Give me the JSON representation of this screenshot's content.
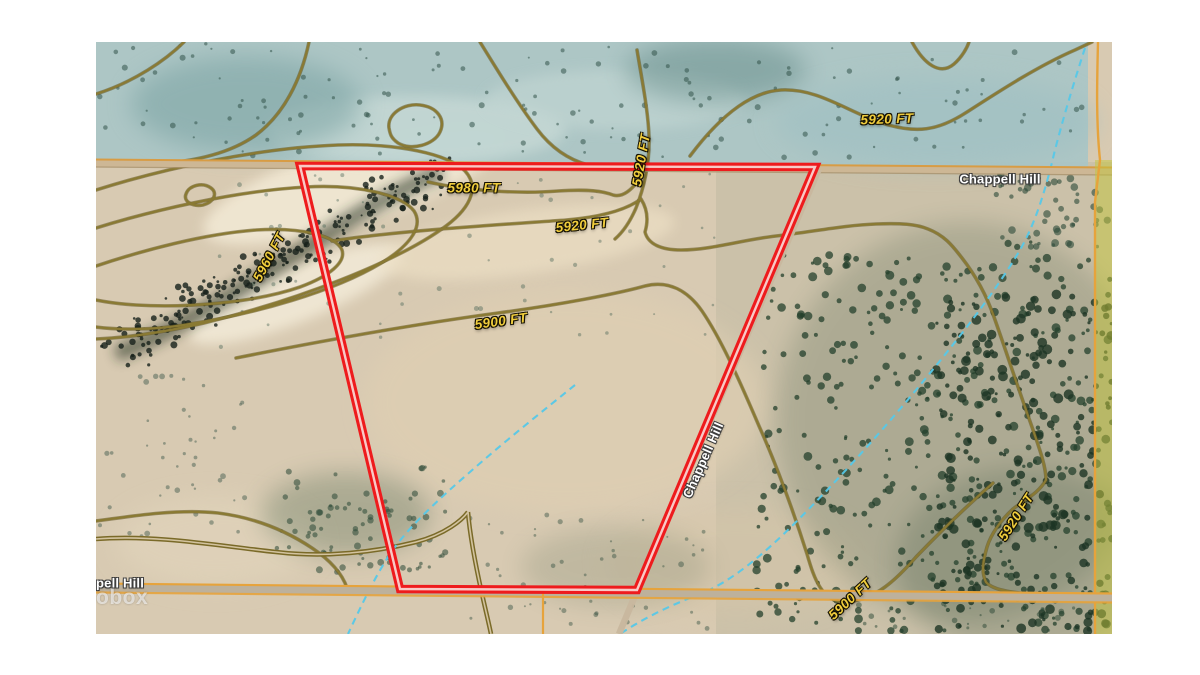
{
  "map": {
    "description_hint": "satellite topographic map with parcel boundary overlay",
    "contour_labels": {
      "ne_5920": "5920 FT",
      "nw_5980": "5980 FT",
      "mid_5920": "5920 FT",
      "mid_5900": "5900 FT",
      "west_5960": "5960 FT",
      "top_5920": "5920 FT",
      "east_5920": "5920 FT",
      "south_5900": "5900 FT"
    },
    "road_labels": {
      "top": "Chappell Hill",
      "diagonal": "Chappell Hill",
      "bottom_clipped": "pell Hill"
    },
    "watermark": "obox",
    "colors": {
      "parcel_outline": "#ee1b1d",
      "parcel_inner_stripe": "#f9c9c6",
      "contour": "#8a7a33",
      "contour_label": "#f0cd3d",
      "road_orange": "#e6a33c",
      "stream_cyan": "#56c8e8",
      "water_tint": "#a9c6c7",
      "terrain_tan": "#d8cab2",
      "forest_green": "#26402e",
      "right_strip_yellow": "#c3c63c"
    }
  }
}
